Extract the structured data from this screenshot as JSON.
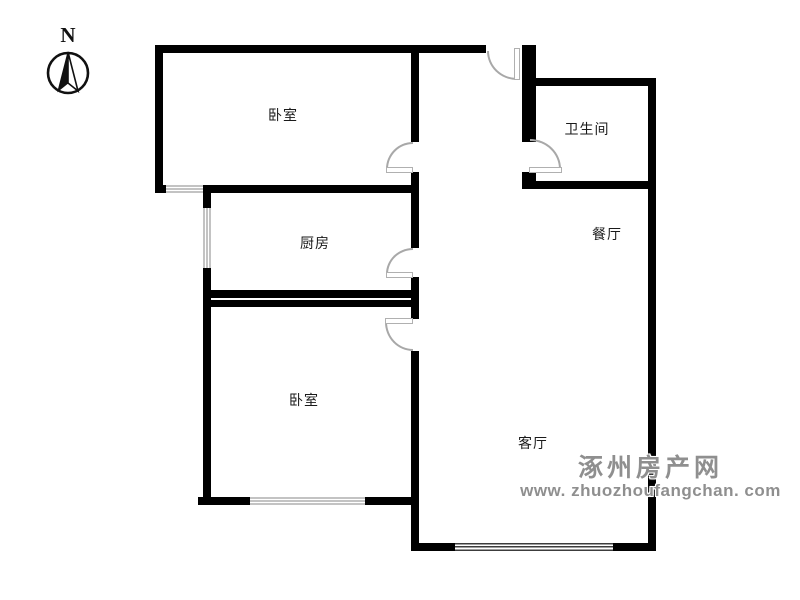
{
  "compass": {
    "label": "N"
  },
  "rooms": {
    "bedroom_top": {
      "label": "卧室"
    },
    "bathroom": {
      "label": "卫生间"
    },
    "kitchen": {
      "label": "厨房"
    },
    "dining": {
      "label": "餐厅"
    },
    "bedroom_bottom": {
      "label": "卧室"
    },
    "living_room": {
      "label": "客厅"
    }
  },
  "watermark": {
    "site_name": "涿州房产网",
    "site_url": "www. zhuozhoufangchan. com"
  },
  "colors": {
    "wall": "#000000",
    "door_arc": "#a8a8a8",
    "window": "#c3c3c3",
    "watermark": "#8f8f8f"
  }
}
